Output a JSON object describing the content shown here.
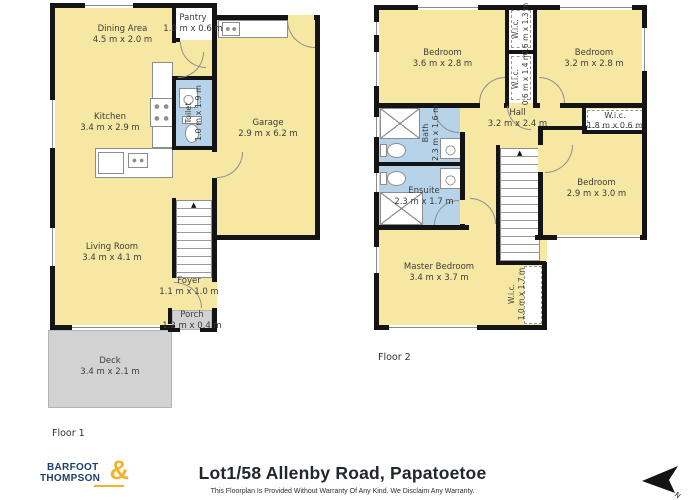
{
  "colors": {
    "room_fill": "#f6e8a2",
    "wet_fill": "#b6d3e9",
    "deck_fill": "#d2d2d2",
    "wall": "#141414",
    "logo_navy": "#1c3e70",
    "logo_gold": "#f3b229",
    "title_color": "#22262d"
  },
  "floor1": {
    "label": "Floor 1",
    "rooms": {
      "dining": {
        "name": "Dining Area",
        "dims": "4.5 m x 2.0 m"
      },
      "pantry": {
        "name": "Pantry",
        "dims": "1.0 m x 0.6 m"
      },
      "kitchen": {
        "name": "Kitchen",
        "dims": "3.4 m x 2.9 m"
      },
      "toilet": {
        "name": "Toilet",
        "dims": "1.0 m x 1.9 m"
      },
      "garage": {
        "name": "Garage",
        "dims": "2.9 m x 6.2 m"
      },
      "living": {
        "name": "Living Room",
        "dims": "3.4 m x 4.1 m"
      },
      "foyer": {
        "name": "Foyer",
        "dims": "1.1 m x 1.0 m"
      },
      "porch": {
        "name": "Porch",
        "dims": "1.2 m x 0.4 m"
      },
      "deck": {
        "name": "Deck",
        "dims": "3.4 m x 2.1 m"
      }
    }
  },
  "floor2": {
    "label": "Floor 2",
    "rooms": {
      "bedroom_nw": {
        "name": "Bedroom",
        "dims": "3.6 m x 2.8 m"
      },
      "wic_top": {
        "name": "W.i.c.",
        "dims": "0.6 m x 1.3 m"
      },
      "wic_mid": {
        "name": "W.i.c.",
        "dims": "0.6 m x 1.4 m"
      },
      "bedroom_ne": {
        "name": "Bedroom",
        "dims": "3.2 m x 2.8 m"
      },
      "bath": {
        "name": "Bath",
        "dims": "2.3 m x 1.6 m"
      },
      "hall": {
        "name": "Hall",
        "dims": "3.2 m x 2.4 m"
      },
      "wic_east": {
        "name": "W.i.c.",
        "dims": "1.8 m x 0.6 m"
      },
      "bedroom_e": {
        "name": "Bedroom",
        "dims": "2.9 m x 3.0 m"
      },
      "ensuite": {
        "name": "Ensuite",
        "dims": "2.3 m x 1.7 m"
      },
      "master": {
        "name": "Master Bedroom",
        "dims": "3.4 m x 3.7 m"
      },
      "wic_master": {
        "name": "W.i.c.",
        "dims": "1.0 m x 1.7 m"
      }
    }
  },
  "footer": {
    "logo": {
      "line1": "BARFOOT",
      "line2": "THOMPSON",
      "ampersand": "&"
    },
    "title": "Lot1/58 Allenby Road, Papatoetoe",
    "disclaimer": "This Floorplan Is Provided Without Warranty Of Any Kind. We Disclaim Any Warranty.",
    "north_label": "N"
  }
}
